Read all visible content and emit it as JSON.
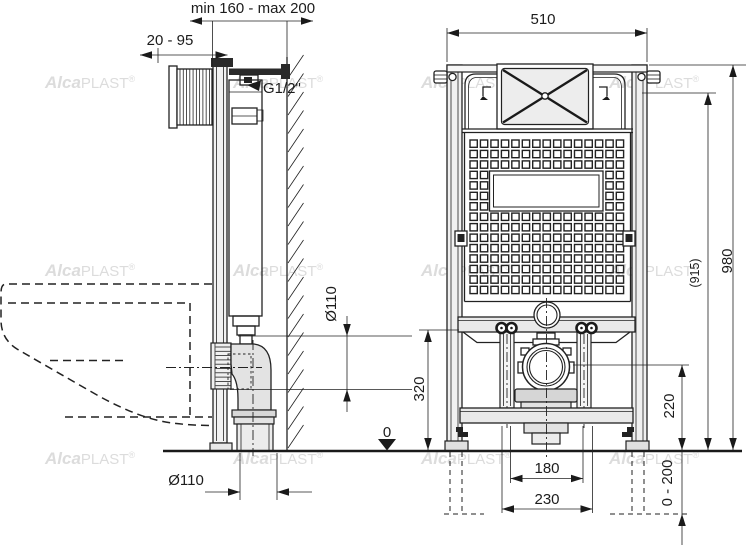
{
  "watermark": {
    "bold": "Alca",
    "rest": "PLAST",
    "reg": "®"
  },
  "side_view": {
    "label_depth_range": "min 160 - max 200",
    "label_shaft_range": "20 - 95",
    "label_water_connection": "G1/2\"",
    "label_outlet_diameter": "Ø110",
    "label_outlet_diameter_bottom": "Ø110",
    "label_floor_datum": "0"
  },
  "front_view": {
    "label_width": "510",
    "label_height": "980",
    "label_height_secondary": "(915)",
    "label_rail_height": "320",
    "label_outlet_axis_height": "220",
    "label_bolt_spacing_inner": "180",
    "label_bolt_spacing_outer": "230",
    "label_feet_adjustment": "0 - 200"
  }
}
